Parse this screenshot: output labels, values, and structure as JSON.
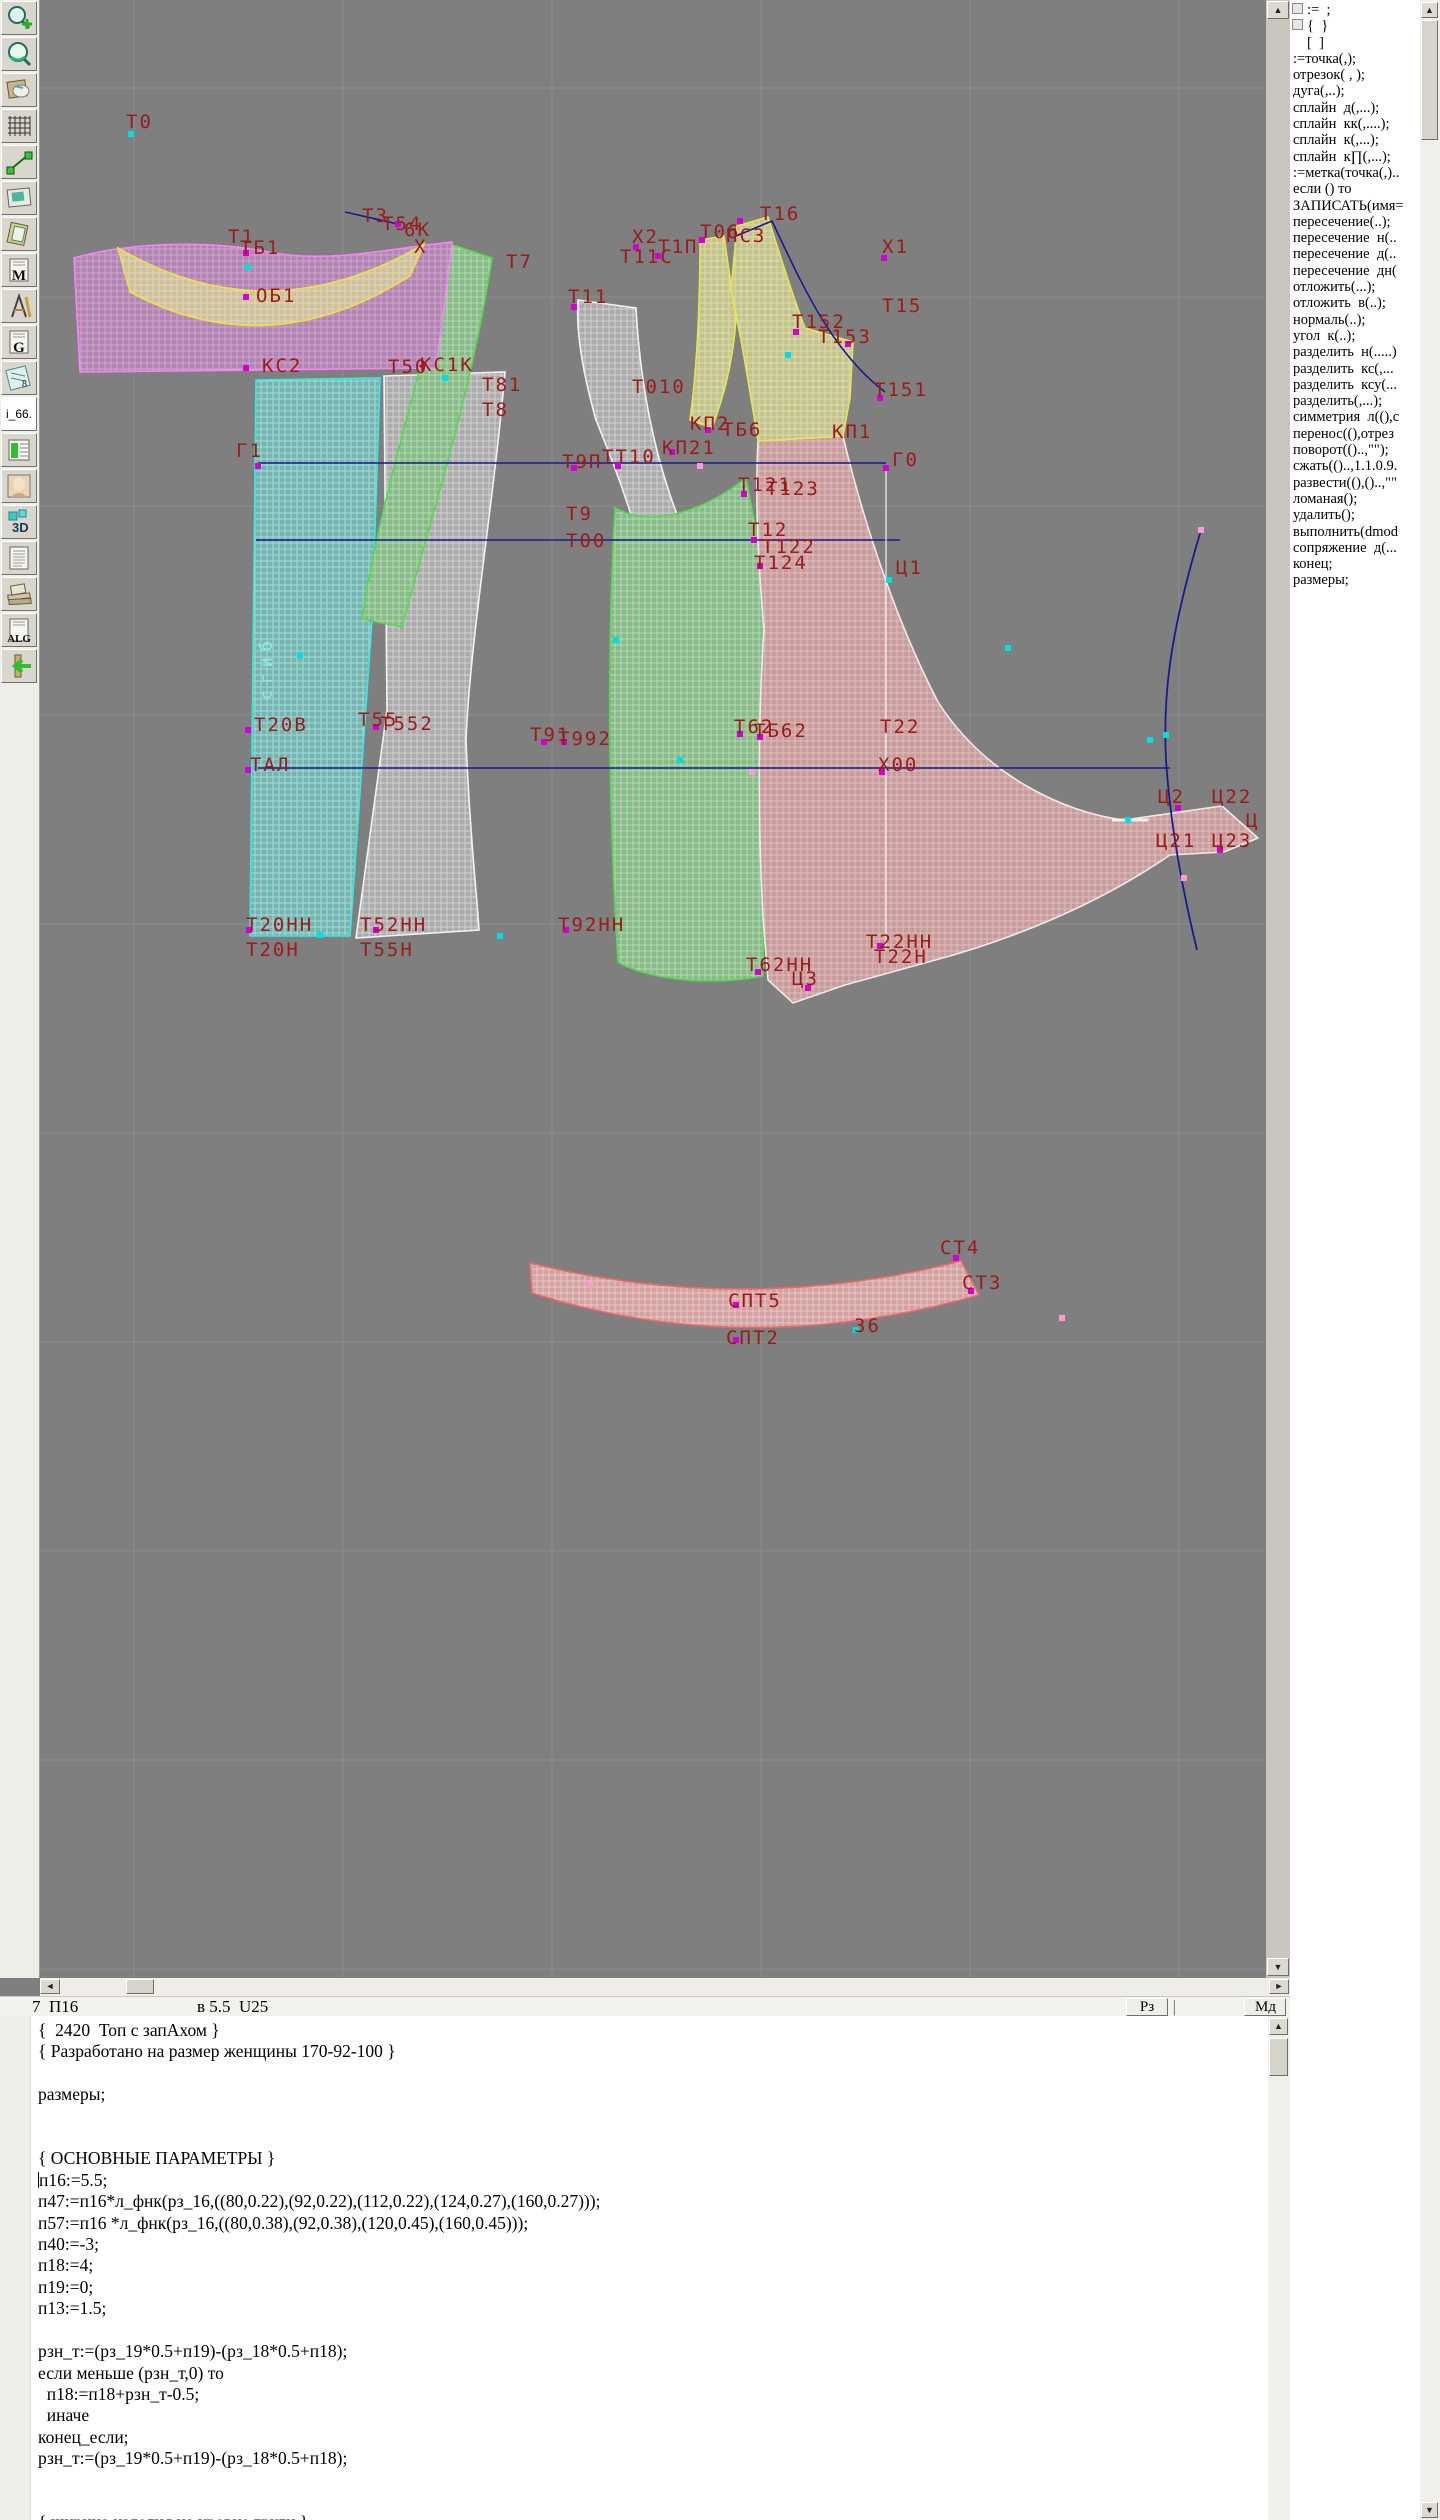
{
  "toolbar": {
    "items": [
      {
        "name": "zoom-in-button",
        "icon": "zoom-in-icon",
        "glyph": ""
      },
      {
        "name": "zoom-view-button",
        "icon": "magnifier-icon",
        "glyph": ""
      },
      {
        "name": "patterns-doc-button",
        "icon": "pattern-sheets-icon",
        "glyph": ""
      },
      {
        "name": "grid-table-button",
        "icon": "grid-icon",
        "glyph": ""
      },
      {
        "name": "segment-tool-button",
        "icon": "segment-icon",
        "glyph": ""
      },
      {
        "name": "image-view-button",
        "icon": "picture-icon",
        "glyph": ""
      },
      {
        "name": "pattern-sheet-button",
        "icon": "tilted-sheet-icon",
        "glyph": ""
      },
      {
        "name": "m-document-button",
        "icon": "letter-doc-icon",
        "glyph": "M"
      },
      {
        "name": "drafting-tools-button",
        "icon": "drafting-icon",
        "glyph": ""
      },
      {
        "name": "g-document-button",
        "icon": "letter-doc-icon",
        "glyph": "G"
      },
      {
        "name": "ruler-document-button",
        "icon": "ruler-icon",
        "glyph": "8"
      },
      {
        "name": "i66-label",
        "icon": "text-label",
        "glyph": "i_66."
      },
      {
        "name": "size-table-button",
        "icon": "green-table-icon",
        "glyph": ""
      },
      {
        "name": "model-photo-button",
        "icon": "photo-icon",
        "glyph": ""
      },
      {
        "name": "view-3d-button",
        "icon": "cube-3d-icon",
        "glyph": "3D"
      },
      {
        "name": "text-document-button",
        "icon": "lined-doc-icon",
        "glyph": ""
      },
      {
        "name": "reference-books-button",
        "icon": "books-icon",
        "glyph": ""
      },
      {
        "name": "algorithm-doc-button",
        "icon": "letter-doc-icon",
        "glyph": "ALG"
      },
      {
        "name": "exit-button",
        "icon": "exit-arrow-icon",
        "glyph": ""
      }
    ]
  },
  "sidebar": {
    "commands": [
      ":=  ;",
      "{  }",
      "[  ]",
      ":=точка(,);",
      "отрезок( , );",
      "дуга(,..);",
      "сплайн  д(,...);",
      "сплайн  кк(,....);",
      "сплайн  к(,...);",
      "сплайн  к∏(,...);",
      ":=метка(точка(,)..",
      "если () то",
      "ЗАПИСАТЬ(имя=",
      "пересечение(..);",
      "пересечение  н(..",
      "пересечение  д(..",
      "пересечение  дн(",
      "отложить(...);",
      "отложить  в(..);",
      "нормаль(..);",
      "угол  к(..);",
      "разделить  н(.....)",
      "разделить  кс(,...",
      "разделить  ксу(...",
      "разделить(,...);",
      "симметрия  л((),с",
      "перенос((),отрез",
      "поворот(()..,\"\");",
      "сжать(()..,1.1.0.9.",
      "развести((),()..,\"\"",
      "ломаная();",
      "удалить();",
      "выполнить(dmod",
      "сопряжение  д(...",
      "конец;",
      "размеры;"
    ]
  },
  "statusbar": {
    "left_text": "7  П16",
    "mid_text": "в 5.5  U25",
    "buttons": [
      "Рз",
      "Мд"
    ],
    "separator": "|"
  },
  "editor": {
    "lines": [
      "{  2420  Топ с запАхом }",
      "{ Разработано на размер женщины 170-92-100 }",
      "",
      "размеры;",
      "",
      "",
      "{ ОСНОВНЫЕ ПАРАМЕТРЫ }",
      "п16:=5.5;",
      "п47:=п16*л_фнк(рз_16,((80,0.22),(92,0.22),(112,0.22),(124,0.27),(160,0.27)));",
      "п57:=п16 *л_фнк(рз_16,((80,0.38),(92,0.38),(120,0.45),(160,0.45)));",
      "п40:=-3;",
      "п18:=4;",
      "п19:=0;",
      "п13:=1.5;",
      "",
      "рзн_т:=(рз_19*0.5+п19)-(рз_18*0.5+п18);",
      "если меньше (рзн_т,0) то",
      "  п18:=п18+рзн_т-0.5;",
      "  иначе",
      "конец_если;",
      "рзн_т:=(рз_19*0.5+п19)-(рз_18*0.5+п18);",
      "",
      "",
      "{ ширина изделия на уровне груди }"
    ],
    "caret_line_index": 7
  },
  "canvas": {
    "background": "#7f7f7f",
    "grid_color": "#8d8d8d",
    "label_color": "#9b1a1a",
    "blue_line_color": "#1a1a8f",
    "grid_x": [
      134,
      343,
      552,
      761,
      970,
      1179
    ],
    "grid_y": [
      88,
      297,
      506,
      715,
      924,
      1133,
      1342,
      1551,
      1760,
      1969
    ],
    "pieces": [
      {
        "name": "panel-back-fold",
        "pat": "cyanP",
        "stroke": "#3ae8e4",
        "d": "M 256 380 L 380 378 L 372 620 L 350 936 L 250 936 Z"
      },
      {
        "name": "panel-side-back",
        "pat": "whiteP",
        "stroke": "#f2f2f2",
        "d": "M 384 376 L 505 372 C 494 500 470 640 466 740 C 470 840 477 894 479 930 L 356 938 L 387 710 Z"
      },
      {
        "name": "armhole-band-green",
        "pat": "greenP",
        "stroke": "#56d856",
        "d": "M 450 244 L 492 258 C 470 400 430 520 402 627 L 362 619 C 380 500 420 380 450 244 Z"
      },
      {
        "name": "armhole-band-white",
        "pat": "whiteP",
        "stroke": "#f2f2f2",
        "d": "M 578 300 L 636 308 C 642 420 668 500 696 560 L 702 625 L 655 630 C 648 550 620 480 596 420 C 582 370 576 330 578 300 Z"
      },
      {
        "name": "panel-side-front",
        "pat": "greenP",
        "stroke": "#56d856",
        "d": "M 615 508 C 660 532 716 502 746 478 L 758 540 C 766 630 770 716 766 830 L 763 976 C 700 988 640 976 618 962 C 608 800 607 650 615 508 Z"
      },
      {
        "name": "front-wrap-piece",
        "pat": "pinkP",
        "stroke": "#efe9e9",
        "d": "M 758 441 L 843 436 C 864 525 898 625 938 702 C 985 775 1062 812 1124 820 L 1222 806 L 1258 838 L 1224 852 L 1170 855 C 1096 906 1008 941 928 962 L 845 985 L 793 1003 L 768 980 L 763 916 C 758 830 758 712 764 630 C 758 560 755 500 758 441 Z"
      },
      {
        "name": "shoulder-strip-yellow",
        "pat": "yellowP",
        "stroke": "#e9e455",
        "d": "M 700 240 L 724 236 L 736 320 C 732 370 722 400 712 428 L 690 420 C 698 360 700 300 700 240 Z"
      },
      {
        "name": "upper-front-yellow",
        "pat": "yellowP",
        "stroke": "#e9e455",
        "d": "M 737 226 L 768 217 C 782 262 794 300 805 328 L 853 342 L 850 398 L 843 436 L 758 441 C 748 380 740 330 731 290 Z"
      },
      {
        "name": "back-yoke-magenta",
        "pat": "magentaP",
        "stroke": "#f983f9",
        "d": "M 74 258 C 130 242 210 240 268 252 C 330 264 392 248 452 242 L 436 368 L 80 372 Z"
      },
      {
        "name": "neckband-tan",
        "pat": "tanP",
        "stroke": "#ece04e",
        "d": "M 118 248 Q 268 336 424 244 L 410 276 Q 268 366 130 292 Z"
      },
      {
        "name": "collar-band",
        "pat": "collarP",
        "stroke": "#ea6a6a",
        "d": "M 530 1263 Q 746 1316 961 1261 L 979 1295 Q 746 1361 532 1293 Z"
      }
    ],
    "blue_lines": [
      {
        "name": "chest-line-g1-g0",
        "d": "M 258 463 H 886",
        "w": 1.6
      },
      {
        "name": "bust-line",
        "d": "M 256 540 H 900",
        "w": 1.6
      },
      {
        "name": "waist-line-tal-x00",
        "d": "M 258 768 H 1170",
        "w": 1.6
      },
      {
        "name": "neck-segment",
        "d": "M 345 212 L 398 224",
        "w": 1.6
      },
      {
        "name": "neck-curve-right",
        "d": "M 736 236 L 772 221 C 800 280 830 350 885 392",
        "w": 1.6
      },
      {
        "name": "side-seam-curve",
        "d": "M 1201 530 C 1168 640 1163 700 1166 760 C 1170 820 1180 880 1197 950",
        "w": 1.8
      }
    ],
    "white_lines": [
      {
        "name": "center-front-line",
        "d": "M 886 465 V 950",
        "w": 1.2
      },
      {
        "name": "tail-notch",
        "d": "M 1112 820 H 1148",
        "w": 3
      }
    ],
    "labels": [
      [
        "Т0",
        126,
        128
      ],
      [
        "Т1",
        228,
        243
      ],
      [
        "ТБ1",
        240,
        254
      ],
      [
        "ОБ1",
        256,
        302
      ],
      [
        "Т3",
        362,
        222
      ],
      [
        "Т54",
        382,
        230
      ],
      [
        "6К",
        404,
        236
      ],
      [
        "Х",
        414,
        253
      ],
      [
        "Т7",
        506,
        268
      ],
      [
        "Х2",
        632,
        243
      ],
      [
        "Т11С",
        620,
        263
      ],
      [
        "Т1П",
        658,
        253
      ],
      [
        "Т06",
        700,
        238
      ],
      [
        "ПС3",
        726,
        242
      ],
      [
        "Т16",
        760,
        220
      ],
      [
        "Х1",
        882,
        253
      ],
      [
        "Т11",
        568,
        303
      ],
      [
        "Т15",
        882,
        312
      ],
      [
        "Т152",
        792,
        328
      ],
      [
        "Т153",
        818,
        343
      ],
      [
        "Т151",
        874,
        396
      ],
      [
        "КС2",
        262,
        372
      ],
      [
        "Т50",
        388,
        373
      ],
      [
        "КС1К",
        420,
        371
      ],
      [
        "Т81",
        482,
        391
      ],
      [
        "Т8",
        482,
        416
      ],
      [
        "Т010",
        632,
        393
      ],
      [
        "КП2",
        690,
        430
      ],
      [
        "ТБ6",
        722,
        436
      ],
      [
        "КП21",
        662,
        454
      ],
      [
        "КП1",
        832,
        438
      ],
      [
        "Г1",
        236,
        457
      ],
      [
        "Т9П",
        562,
        468
      ],
      [
        "ТТ10",
        602,
        463
      ],
      [
        "Г0",
        892,
        466
      ],
      [
        "Т121",
        738,
        491
      ],
      [
        "Т123",
        766,
        495
      ],
      [
        "Т9",
        566,
        520
      ],
      [
        "Т00",
        566,
        547
      ],
      [
        "Т12",
        748,
        536
      ],
      [
        "Т122",
        762,
        553
      ],
      [
        "Т124",
        754,
        569
      ],
      [
        "Ц1",
        896,
        574
      ],
      [
        "Т20В",
        254,
        731
      ],
      [
        "Т55",
        358,
        726
      ],
      [
        "Т552",
        380,
        730
      ],
      [
        "Т91",
        530,
        741
      ],
      [
        "Т992",
        558,
        745
      ],
      [
        "Т62",
        734,
        733
      ],
      [
        "ТБ62",
        754,
        737
      ],
      [
        "Т22",
        880,
        733
      ],
      [
        "ТАЛ",
        250,
        771
      ],
      [
        "Х00",
        878,
        771
      ],
      [
        "Ц2",
        1158,
        803
      ],
      [
        "Ц22",
        1212,
        803
      ],
      [
        "Ц",
        1246,
        827
      ],
      [
        "Ц21",
        1156,
        847
      ],
      [
        "Ц23",
        1212,
        847
      ],
      [
        "Т20НН",
        246,
        931
      ],
      [
        "Т20Н",
        246,
        956
      ],
      [
        "Т52НН",
        360,
        931
      ],
      [
        "Т55Н",
        360,
        956
      ],
      [
        "Т92НН",
        558,
        931
      ],
      [
        "Т62НН",
        746,
        971
      ],
      [
        "Ц3",
        792,
        985
      ],
      [
        "Т22НН",
        866,
        948
      ],
      [
        "Т22Н",
        874,
        963
      ],
      [
        "СТ4",
        940,
        1254
      ],
      [
        "СТ3",
        962,
        1289
      ],
      [
        "СПТ5",
        728,
        1307
      ],
      [
        "СПТ2",
        726,
        1344
      ],
      [
        "З6",
        854,
        1332
      ]
    ],
    "fold_text": {
      "text": "сгиб",
      "x": 272,
      "y": 700
    },
    "markers": [
      [
        131,
        134,
        "c"
      ],
      [
        246,
        253,
        "m"
      ],
      [
        248,
        267,
        "c"
      ],
      [
        246,
        297,
        "m"
      ],
      [
        246,
        368,
        "m"
      ],
      [
        445,
        378,
        "c"
      ],
      [
        398,
        224,
        "m"
      ],
      [
        574,
        307,
        "m"
      ],
      [
        636,
        247,
        "m"
      ],
      [
        658,
        256,
        "m"
      ],
      [
        702,
        240,
        "m"
      ],
      [
        740,
        221,
        "m"
      ],
      [
        884,
        258,
        "m"
      ],
      [
        796,
        332,
        "m"
      ],
      [
        848,
        344,
        "m"
      ],
      [
        880,
        398,
        "m"
      ],
      [
        788,
        355,
        "c"
      ],
      [
        708,
        430,
        "m"
      ],
      [
        672,
        452,
        "m"
      ],
      [
        886,
        468,
        "m"
      ],
      [
        258,
        466,
        "m"
      ],
      [
        574,
        468,
        "m"
      ],
      [
        618,
        466,
        "m"
      ],
      [
        700,
        466,
        "p"
      ],
      [
        744,
        494,
        "m"
      ],
      [
        754,
        540,
        "m"
      ],
      [
        760,
        566,
        "m"
      ],
      [
        889,
        580,
        "c"
      ],
      [
        616,
        640,
        "c"
      ],
      [
        300,
        655,
        "c"
      ],
      [
        680,
        760,
        "c"
      ],
      [
        1008,
        648,
        "c"
      ],
      [
        248,
        730,
        "m"
      ],
      [
        376,
        727,
        "m"
      ],
      [
        544,
        742,
        "m"
      ],
      [
        564,
        742,
        "m"
      ],
      [
        740,
        734,
        "m"
      ],
      [
        760,
        737,
        "m"
      ],
      [
        248,
        770,
        "m"
      ],
      [
        752,
        772,
        "p"
      ],
      [
        882,
        772,
        "m"
      ],
      [
        1150,
        740,
        "c"
      ],
      [
        1178,
        808,
        "m"
      ],
      [
        1220,
        850,
        "m"
      ],
      [
        1128,
        820,
        "c"
      ],
      [
        249,
        930,
        "m"
      ],
      [
        320,
        935,
        "c"
      ],
      [
        376,
        930,
        "m"
      ],
      [
        500,
        936,
        "c"
      ],
      [
        566,
        930,
        "m"
      ],
      [
        758,
        972,
        "m"
      ],
      [
        808,
        988,
        "m"
      ],
      [
        880,
        946,
        "m"
      ],
      [
        956,
        1258,
        "m"
      ],
      [
        971,
        1291,
        "m"
      ],
      [
        736,
        1305,
        "m"
      ],
      [
        736,
        1340,
        "m"
      ],
      [
        856,
        1330,
        "c"
      ],
      [
        1062,
        1318,
        "p"
      ],
      [
        590,
        1285,
        "p"
      ],
      [
        1201,
        530,
        "p"
      ],
      [
        1184,
        878,
        "p"
      ],
      [
        1166,
        735,
        "c"
      ]
    ]
  }
}
